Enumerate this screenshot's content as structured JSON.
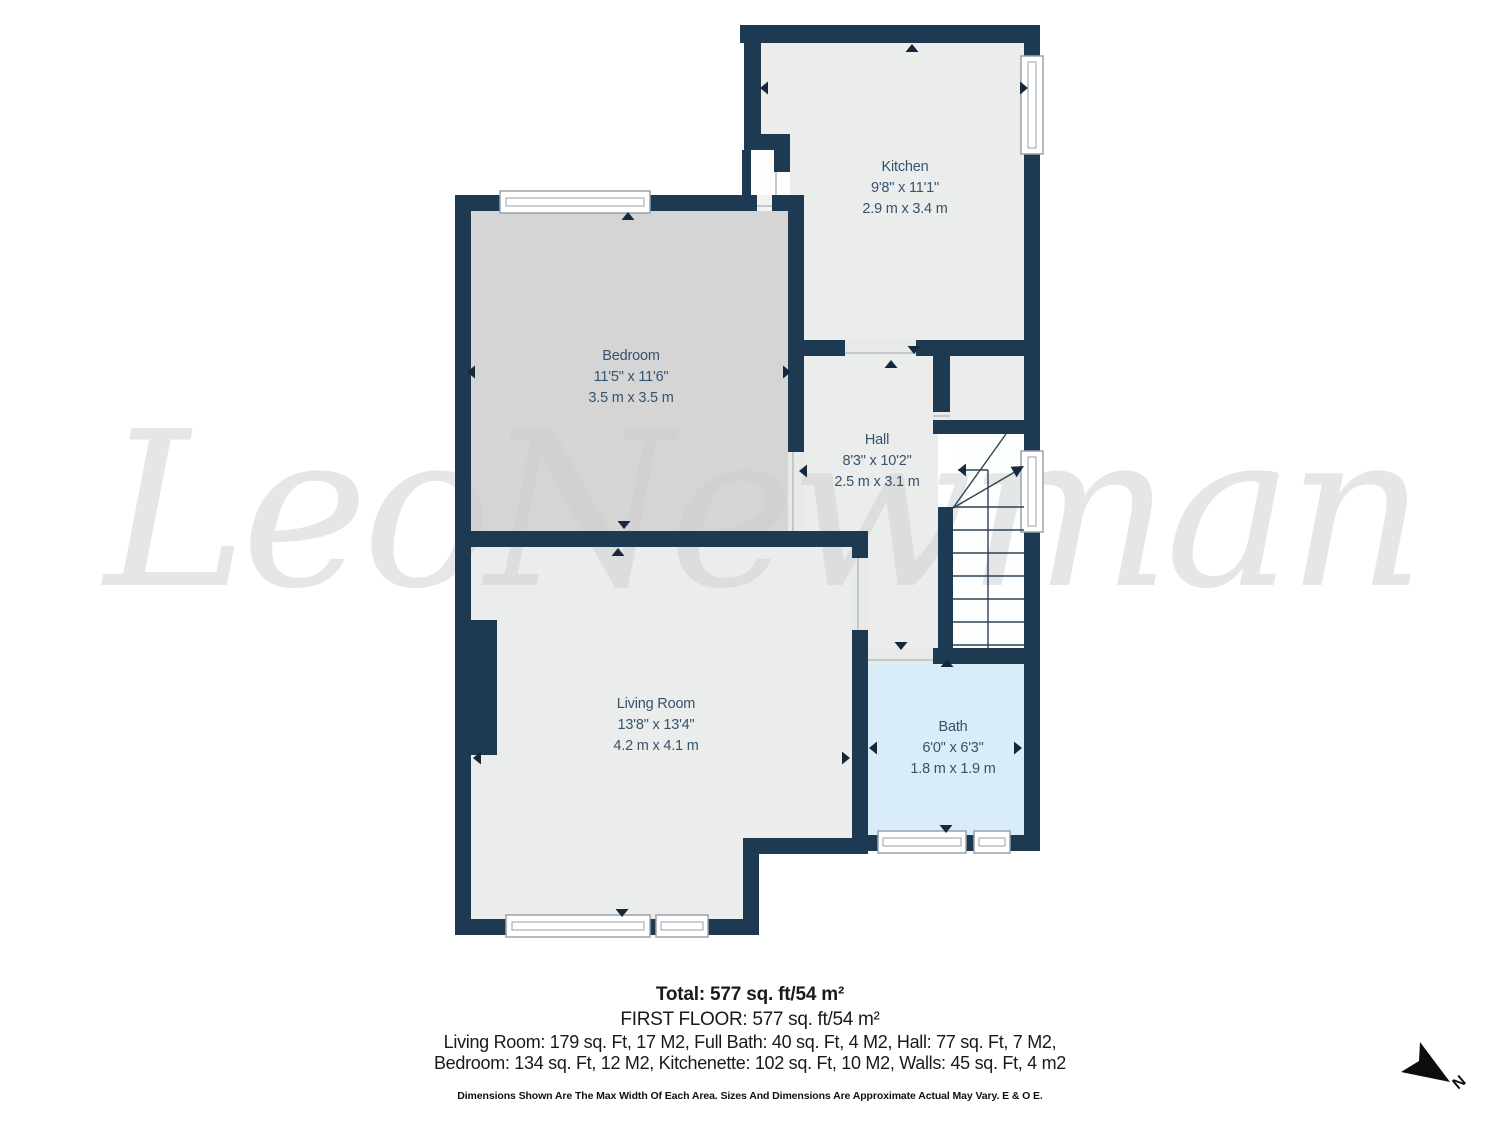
{
  "watermark": {
    "text": "LeoNewman"
  },
  "rooms": {
    "kitchen": {
      "name": "Kitchen",
      "imperial": "9'8\" x 11'1\"",
      "metric": "2.9 m x 3.4 m"
    },
    "bedroom": {
      "name": "Bedroom",
      "imperial": "11'5\" x 11'6\"",
      "metric": "3.5 m x 3.5 m"
    },
    "hall": {
      "name": "Hall",
      "imperial": "8'3\" x 10'2\"",
      "metric": "2.5 m x 3.1 m"
    },
    "living_room": {
      "name": "Living Room",
      "imperial": "13'8\" x 13'4\"",
      "metric": "4.2 m x 4.1 m"
    },
    "bath": {
      "name": "Bath",
      "imperial": "6'0\" x 6'3\"",
      "metric": "1.8 m x 1.9 m"
    }
  },
  "summary": {
    "total": "Total: 577 sq. ft/54 m²",
    "floor": "FIRST FLOOR: 577 sq. ft/54 m²",
    "line1": "Living Room: 179 sq. Ft, 17 M2, Full Bath: 40 sq. Ft, 4 M2, Hall: 77 sq. Ft, 7 M2,",
    "line2": "Bedroom: 134 sq. Ft, 12 M2, Kitchenette: 102 sq. Ft, 10 M2, Walls: 45 sq. Ft, 4 m2",
    "disclaimer": "Dimensions Shown Are The Max Width Of Each Area. Sizes And Dimensions Are Approximate Actual May Vary. E & O E."
  },
  "compass": {
    "label": "N"
  },
  "colors": {
    "wall": "#1d3a52",
    "floor_light": "#ebecec",
    "floor_bedroom": "#d5d5d6",
    "floor_bath": "#d9edf8",
    "label_text": "#35536d",
    "watermark": "#cdcdcd",
    "arrow": "#16293c"
  }
}
